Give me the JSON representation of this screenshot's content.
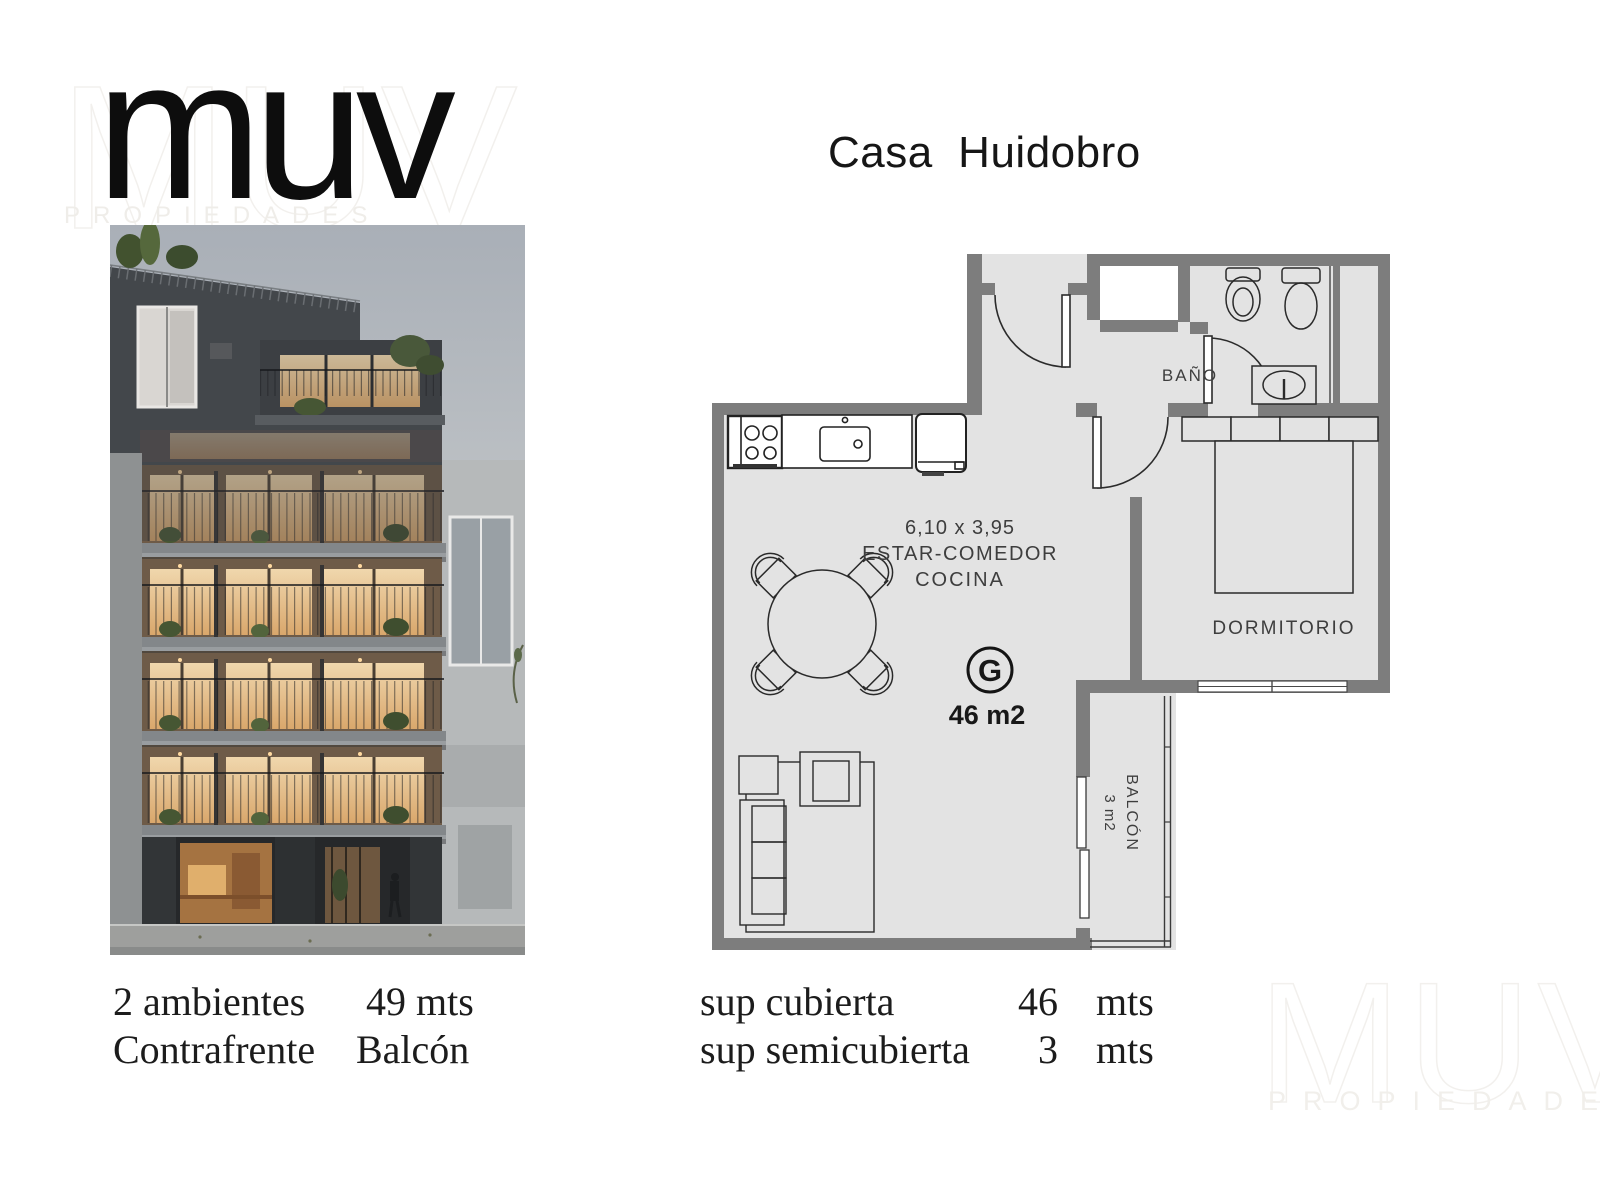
{
  "brand": {
    "logo_text": "muv",
    "logo_subtext": "PROPIEDADES"
  },
  "watermark": {
    "text": "MUV",
    "subtext": "PROPIEDADES"
  },
  "header": {
    "title": "Casa  Huidobro"
  },
  "floorplan": {
    "dimension_label": "6,10 x 3,95",
    "living_label": "ESTAR-COMEDOR",
    "kitchen_label": "COCINA",
    "unit_letter": "G",
    "unit_area_label": "46 m2",
    "bathroom_label": "BAÑO",
    "bedroom_label": "DORMITORIO",
    "balcony_label": "BALCÓN",
    "balcony_area_label": "3 m2"
  },
  "summary_left": {
    "rooms_label": "2 ambientes",
    "rooms_value": "49 mts",
    "orientation_label": "Contrafrente",
    "orientation_value": "Balcón"
  },
  "summary_right": {
    "row1_label": "sup cubierta",
    "row1_value": "46",
    "row1_unit": "mts",
    "row2_label": "sup semicubierta",
    "row2_value": "3",
    "row2_unit": "mts"
  },
  "colors": {
    "wall": "#7d7d7d",
    "floor": "#e3e3e3",
    "line": "#2a2a2a"
  }
}
